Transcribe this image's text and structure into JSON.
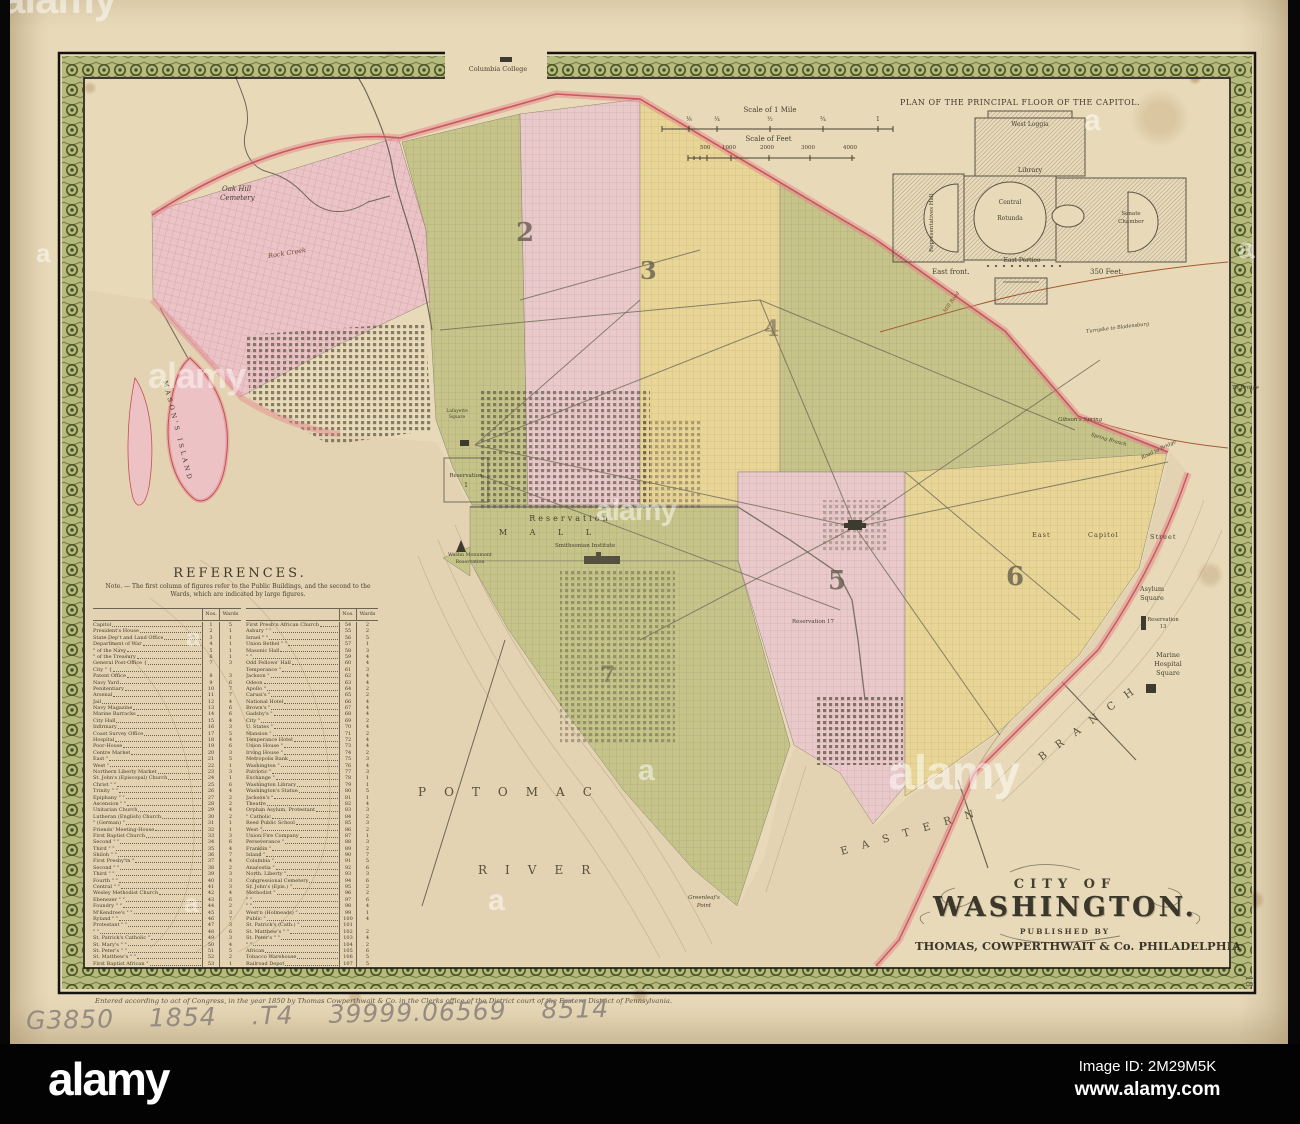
{
  "map_title": "City of Washington map, 1850",
  "title_block": {
    "line1": "CITY OF",
    "line2": "WASHINGTON.",
    "line3": "PUBLISHED BY",
    "line4": "THOMAS, COWPERTHWAIT & Co. PHILADELPHIA"
  },
  "capitol_plan": {
    "title": "PLAN OF THE PRINCIPAL FLOOR OF THE CAPITOL.",
    "labels": {
      "west_loggia": "West Loggia",
      "library": "Library",
      "central": "Central",
      "rotunda": "Rotunda",
      "representatives_hall": "Representatives Hall",
      "senate1": "Senate",
      "senate2": "Chamber",
      "east_portico": "East Portico",
      "east_front": "East front.",
      "feet": "350 Feet."
    }
  },
  "scales": {
    "mile": {
      "title": "Scale of 1 Mile",
      "ticks": [
        "⅛",
        "¼",
        "½",
        "¾",
        "1"
      ]
    },
    "feet": {
      "title": "Scale of Feet",
      "ticks": [
        "500",
        "1000",
        "2000",
        "3000",
        "4000"
      ]
    }
  },
  "references": {
    "heading": "REFERENCES.",
    "note_line1": "Note. — The first column of figures refer to the Public Buildings, and the second to the",
    "note_line2": "Wards, which are indicated by large figures.",
    "col_headers": {
      "nos": "Nos.",
      "wards": "Wards"
    },
    "left": [
      [
        "Capitol",
        "1",
        "5"
      ],
      [
        "President's House",
        "2",
        "1"
      ],
      [
        "State Dep't and Land Office",
        "3",
        "1"
      ],
      [
        "Department of War",
        "4",
        "1"
      ],
      [
        "\" of the Navy",
        "5",
        "1"
      ],
      [
        "\" of the Treasury",
        "6",
        "1"
      ],
      [
        "General Post-Office {",
        "7",
        "3"
      ],
      [
        "City \" {",
        "",
        ""
      ],
      [
        "Patent Office",
        "8",
        "3"
      ],
      [
        "Navy Yard",
        "9",
        "6"
      ],
      [
        "Penitentiary",
        "10",
        "7"
      ],
      [
        "Arsenal",
        "11",
        "7"
      ],
      [
        "Jail",
        "12",
        "4"
      ],
      [
        "Navy Magazine",
        "13",
        "6"
      ],
      [
        "Marine Barracks",
        "14",
        "6"
      ],
      [
        "City Hall",
        "15",
        "4"
      ],
      [
        "Infirmary",
        "16",
        "3"
      ],
      [
        "Coast Survey Office",
        "17",
        "5"
      ],
      [
        "Hospital",
        "18",
        "4"
      ],
      [
        "Poor-House",
        "19",
        "6"
      ],
      [
        "Centre Market",
        "20",
        "3"
      ],
      [
        "East \"",
        "21",
        "5"
      ],
      [
        "West \"",
        "22",
        "1"
      ],
      [
        "Northern Liberty Market",
        "23",
        "3"
      ],
      [
        "St. John's (Episcopal) Church",
        "24",
        "1"
      ],
      [
        "Christ \"  \"",
        "25",
        "6"
      ],
      [
        "Trinity \"  \"",
        "26",
        "4"
      ],
      [
        "Epiphany \"  \"",
        "27",
        "2"
      ],
      [
        "Ascension \"  \"",
        "28",
        "2"
      ],
      [
        "Unitarian Church",
        "29",
        "4"
      ],
      [
        "Lutheran (English) Church",
        "30",
        "2"
      ],
      [
        "\" (German) \"",
        "31",
        "1"
      ],
      [
        "Friends' Meeting-House",
        "32",
        "1"
      ],
      [
        "First Baptist Church",
        "33",
        "3"
      ],
      [
        "Second \"  \"",
        "34",
        "6"
      ],
      [
        "Third \"  \"",
        "35",
        "4"
      ],
      [
        "Shiloh \"  \"",
        "36",
        "7"
      ],
      [
        "First Presby'tn \"",
        "37",
        "4"
      ],
      [
        "Second \"  \"",
        "38",
        "2"
      ],
      [
        "Third \"  \"",
        "39",
        "3"
      ],
      [
        "Fourth \"  \"",
        "40",
        "3"
      ],
      [
        "Central \"  \"",
        "41",
        "3"
      ],
      [
        "Wesley Methodist Church",
        "42",
        "4"
      ],
      [
        "Ebenezer \"  \"",
        "43",
        "6"
      ],
      [
        "Foundry \"  \"",
        "44",
        "2"
      ],
      [
        "M'Kendree's \"  \"",
        "45",
        "3"
      ],
      [
        "Ryland \"  \"",
        "46",
        "7"
      ],
      [
        "Protestant \"  \"",
        "47",
        "3"
      ],
      [
        "\"  \"",
        "48",
        "6"
      ],
      [
        "St. Patrick's Catholic \"",
        "49",
        "3"
      ],
      [
        "St. Mary's \"  \"",
        "50",
        "4"
      ],
      [
        "St. Peter's \"  \"",
        "51",
        "5"
      ],
      [
        "St. Matthew's \"  \"",
        "52",
        "2"
      ],
      [
        "First Baptist African \"",
        "53",
        "1"
      ]
    ],
    "right": [
      [
        "First Presb'n African Church",
        "54",
        "2"
      ],
      [
        "Asbury \"  \"",
        "55",
        "2"
      ],
      [
        "Israel \"  \"",
        "56",
        "5"
      ],
      [
        "Union Bethel \"  \"",
        "57",
        "1"
      ],
      [
        "Masonic Hall",
        "58",
        "3"
      ],
      [
        "\"  \"",
        "59",
        "4"
      ],
      [
        "Odd Fellows' Hall",
        "60",
        "4"
      ],
      [
        "Temperance \"",
        "61",
        "3"
      ],
      [
        "Jackson \"",
        "62",
        "4"
      ],
      [
        "Odeon",
        "63",
        "4"
      ],
      [
        "Apollo \"",
        "64",
        "2"
      ],
      [
        "Carusi's \"",
        "65",
        "2"
      ],
      [
        "National Hotel",
        "66",
        "4"
      ],
      [
        "Brown's \"",
        "67",
        "4"
      ],
      [
        "Gadsby's \"",
        "68",
        "4"
      ],
      [
        "City \"",
        "69",
        "2"
      ],
      [
        "U. States \"",
        "70",
        "4"
      ],
      [
        "Mansion \"",
        "71",
        "2"
      ],
      [
        "Temperance Hotel",
        "72",
        "4"
      ],
      [
        "Union House \"",
        "73",
        "4"
      ],
      [
        "Irving House \"",
        "74",
        "2"
      ],
      [
        "Metropolis Bank",
        "75",
        "3"
      ],
      [
        "Washington \"",
        "76",
        "4"
      ],
      [
        "Patriotic \"",
        "77",
        "3"
      ],
      [
        "Exchange \"",
        "78",
        "1"
      ],
      [
        "Washington Library",
        "79",
        "1"
      ],
      [
        "Washington's Statue",
        "80",
        "5"
      ],
      [
        "Jackson's \"",
        "81",
        "1"
      ],
      [
        "Theatre",
        "82",
        "4"
      ],
      [
        "Orphan Asylum, Protestant",
        "83",
        "3"
      ],
      [
        "\" Catholic",
        "84",
        "2"
      ],
      [
        "Reed Public School",
        "85",
        "3"
      ],
      [
        "West \"",
        "86",
        "2"
      ],
      [
        "Union Fire Company",
        "87",
        "1"
      ],
      [
        "Perseverance \"",
        "88",
        "3"
      ],
      [
        "Franklin \"",
        "89",
        "2"
      ],
      [
        "Island \"",
        "90",
        "7"
      ],
      [
        "Columbia \"",
        "91",
        "5"
      ],
      [
        "Anacostia \"",
        "92",
        "6"
      ],
      [
        "North. Liberty \"",
        "93",
        "3"
      ],
      [
        "Congressional Cemetery",
        "94",
        "6"
      ],
      [
        "St. John's (Epis.) \"",
        "95",
        "2"
      ],
      [
        "Methodist \"",
        "96",
        "2"
      ],
      [
        "\"  \"",
        "97",
        "6"
      ],
      [
        "\"  \"",
        "98",
        "4"
      ],
      [
        "West'n (Holmeads) \"",
        "99",
        "1"
      ],
      [
        "Public \"",
        "100",
        "4"
      ],
      [
        "St. Patrick's (Cath.) \"",
        "101",
        ""
      ],
      [
        "St. Matthew's \"  \"",
        "102",
        "2"
      ],
      [
        "St. Peter's \"  \"",
        "103",
        "4"
      ],
      [
        "\"  \"",
        "104",
        "2"
      ],
      [
        "African",
        "105",
        "6"
      ],
      [
        "Tobacco Warehouse",
        "106",
        "5"
      ],
      [
        "Railroad Depot",
        "107",
        "5"
      ]
    ]
  },
  "map_labels": {
    "columbia_college": "Columbia College",
    "oak_hill_1": "Oak Hill",
    "oak_hill_2": "Cemetery",
    "rock_creek": "Rock Creek",
    "masons_island": "MASON'S ISLAND",
    "reservation_1a": "Reservation",
    "reservation_1b": "1",
    "lafayette_1": "Lafayette",
    "lafayette_2": "Square",
    "mall_res": "Reservation",
    "mall": "M A L L",
    "smithsonian": "Smithsonian Institute",
    "monument_1": "Washn Monument",
    "monument_2": "Reservation",
    "reservation_17": "Reservation 17",
    "east": "East",
    "capitol": "Capitol",
    "street": "Street",
    "asylum_1": "Asylum",
    "asylum_2": "Square",
    "res13_a": "Reservation",
    "res13_b": "13",
    "marine_1": "Marine",
    "marine_2": "Hospital",
    "marine_3": "Square",
    "gibsons_spring": "Gibson's Spring",
    "spring_branch": "Spring Branch",
    "road_to_bridge": "Road to Bridge",
    "to_bridge": "To Bridge",
    "turnpike": "Turnpike to Bladensburg",
    "mill_road": "Mill Road",
    "potomac": "POTOMAC",
    "river": "RIVER",
    "eastern": "EASTERN",
    "branch": "BRANCH",
    "greenleaf_1": "Greenleaf's",
    "greenleaf_2": "Point"
  },
  "ward_numbers": [
    "2",
    "3",
    "4",
    "5",
    "6",
    "7"
  ],
  "page_number": "18.",
  "handwritten_call_number": "G3850 1854&nbsp;.T4 39999.06569 8514",
  "handwriting_plain": "G3850  1854 .T4  39999.06569  8514",
  "imprint": "Entered according to act of Congress, in the year 1850 by Thomas Cowperthwait & Co. in the Clerks office of the District court of the Eastern District of Pennsylvania.",
  "watermark": {
    "brand": "alamy",
    "mark": "a",
    "image_id": "Image ID: 2M29M5K",
    "url": "www.alamy.com"
  },
  "colors": {
    "paper": "#e8dab9",
    "olive": "#c6c489",
    "pink": "#eac9cb",
    "yellow": "#e9d697",
    "georgetown_pink": "#ecc3c6",
    "boundary_red": "#c44f55",
    "halo_pink": "#e4848c",
    "border_green": "#b6ba7e",
    "border_line": "#46511f",
    "water": "#e4d3b2"
  }
}
